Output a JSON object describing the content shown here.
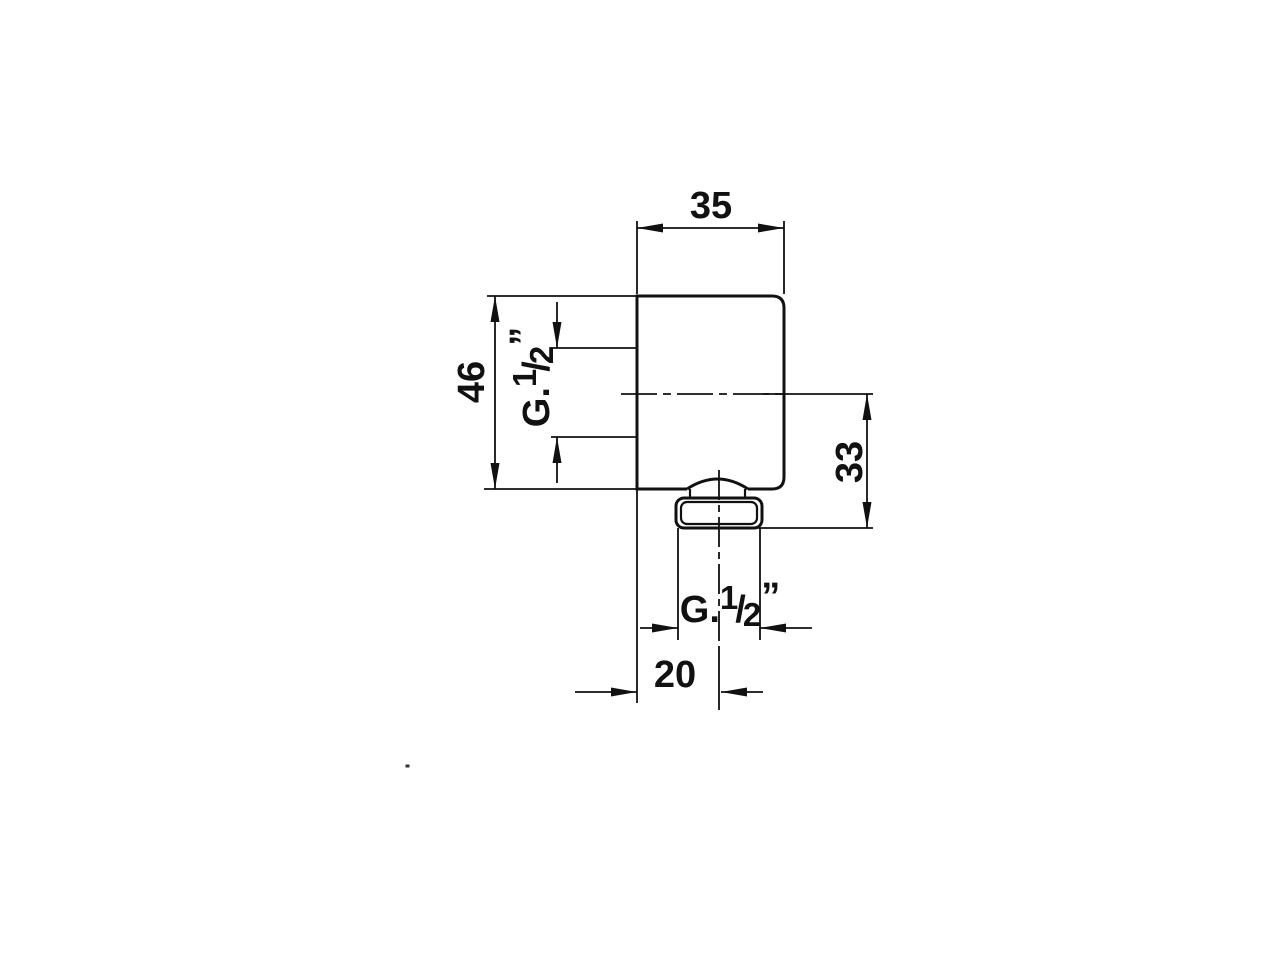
{
  "drawing": {
    "kind": "technical-dimension-drawing",
    "background": "#ffffff",
    "line_color": "#111111",
    "dimensions": {
      "top_width": "35",
      "left_height": "46",
      "right_depth": "33",
      "bottom_offset": "20"
    },
    "thread_label": {
      "prefix": "G.",
      "numerator": "1",
      "slash": "/",
      "denominator": "2",
      "inch_mark": "”"
    }
  }
}
